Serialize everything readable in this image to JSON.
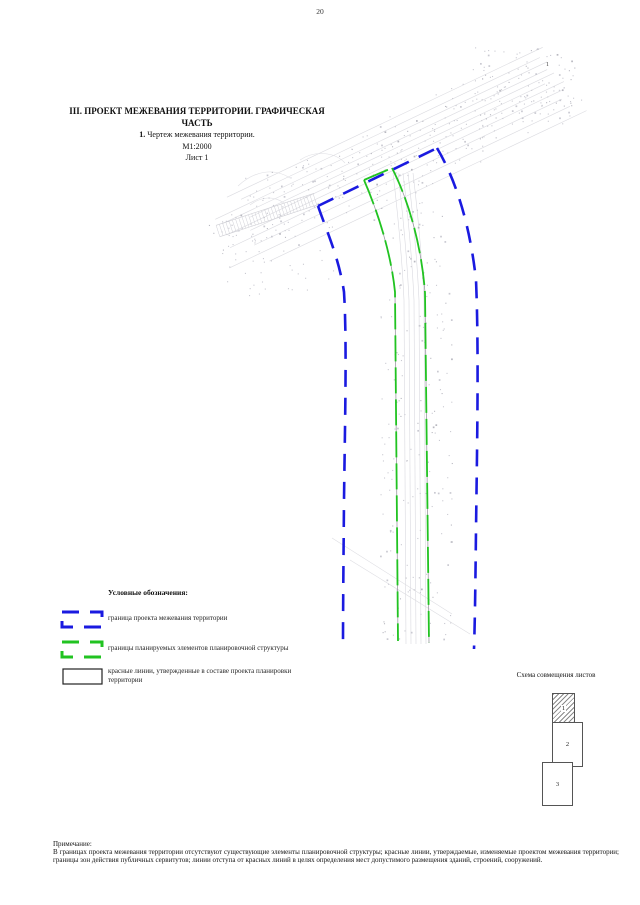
{
  "page": {
    "number": "20"
  },
  "title": {
    "line1": "III. ПРОЕКТ МЕЖЕВАНИЯ ТЕРРИТОРИИ. ГРАФИЧЕСКАЯ",
    "line2": "ЧАСТЬ",
    "line3_num": "1.",
    "line3_rest": " Чертеж межевания территории.",
    "line4": "М1:2000",
    "line5": "Лист 1"
  },
  "map": {
    "marker_label": "1",
    "colors": {
      "boundary_blue": "#1a1ae0",
      "planning_green": "#21c321",
      "red_line_gray": "#9a9aa0",
      "topo_gray": "#dcdce1",
      "dot_gray": "#c9c9d1"
    }
  },
  "legend": {
    "header": "Условные обозначения:",
    "items": [
      {
        "label": "граница проекта межевания территории"
      },
      {
        "label": "границы планируемых элементов планировочной структуры"
      },
      {
        "label": "красные линии, утвержденные в составе проекта планировки территории"
      }
    ]
  },
  "scheme": {
    "title": "Схема совмещения листов",
    "sheets": [
      "1",
      "2",
      "3"
    ]
  },
  "note": {
    "heading": "Примечание:",
    "body": "В границах проекта межевания территории отсутствуют существующие элементы планировочной структуры; красные линии, утверждаемые, изменяемые проектом межевания территории; границы зон действия публичных сервитутов; линии отступа от красных линий в целях определения мест допустимого размещения зданий, строений, сооружений."
  }
}
